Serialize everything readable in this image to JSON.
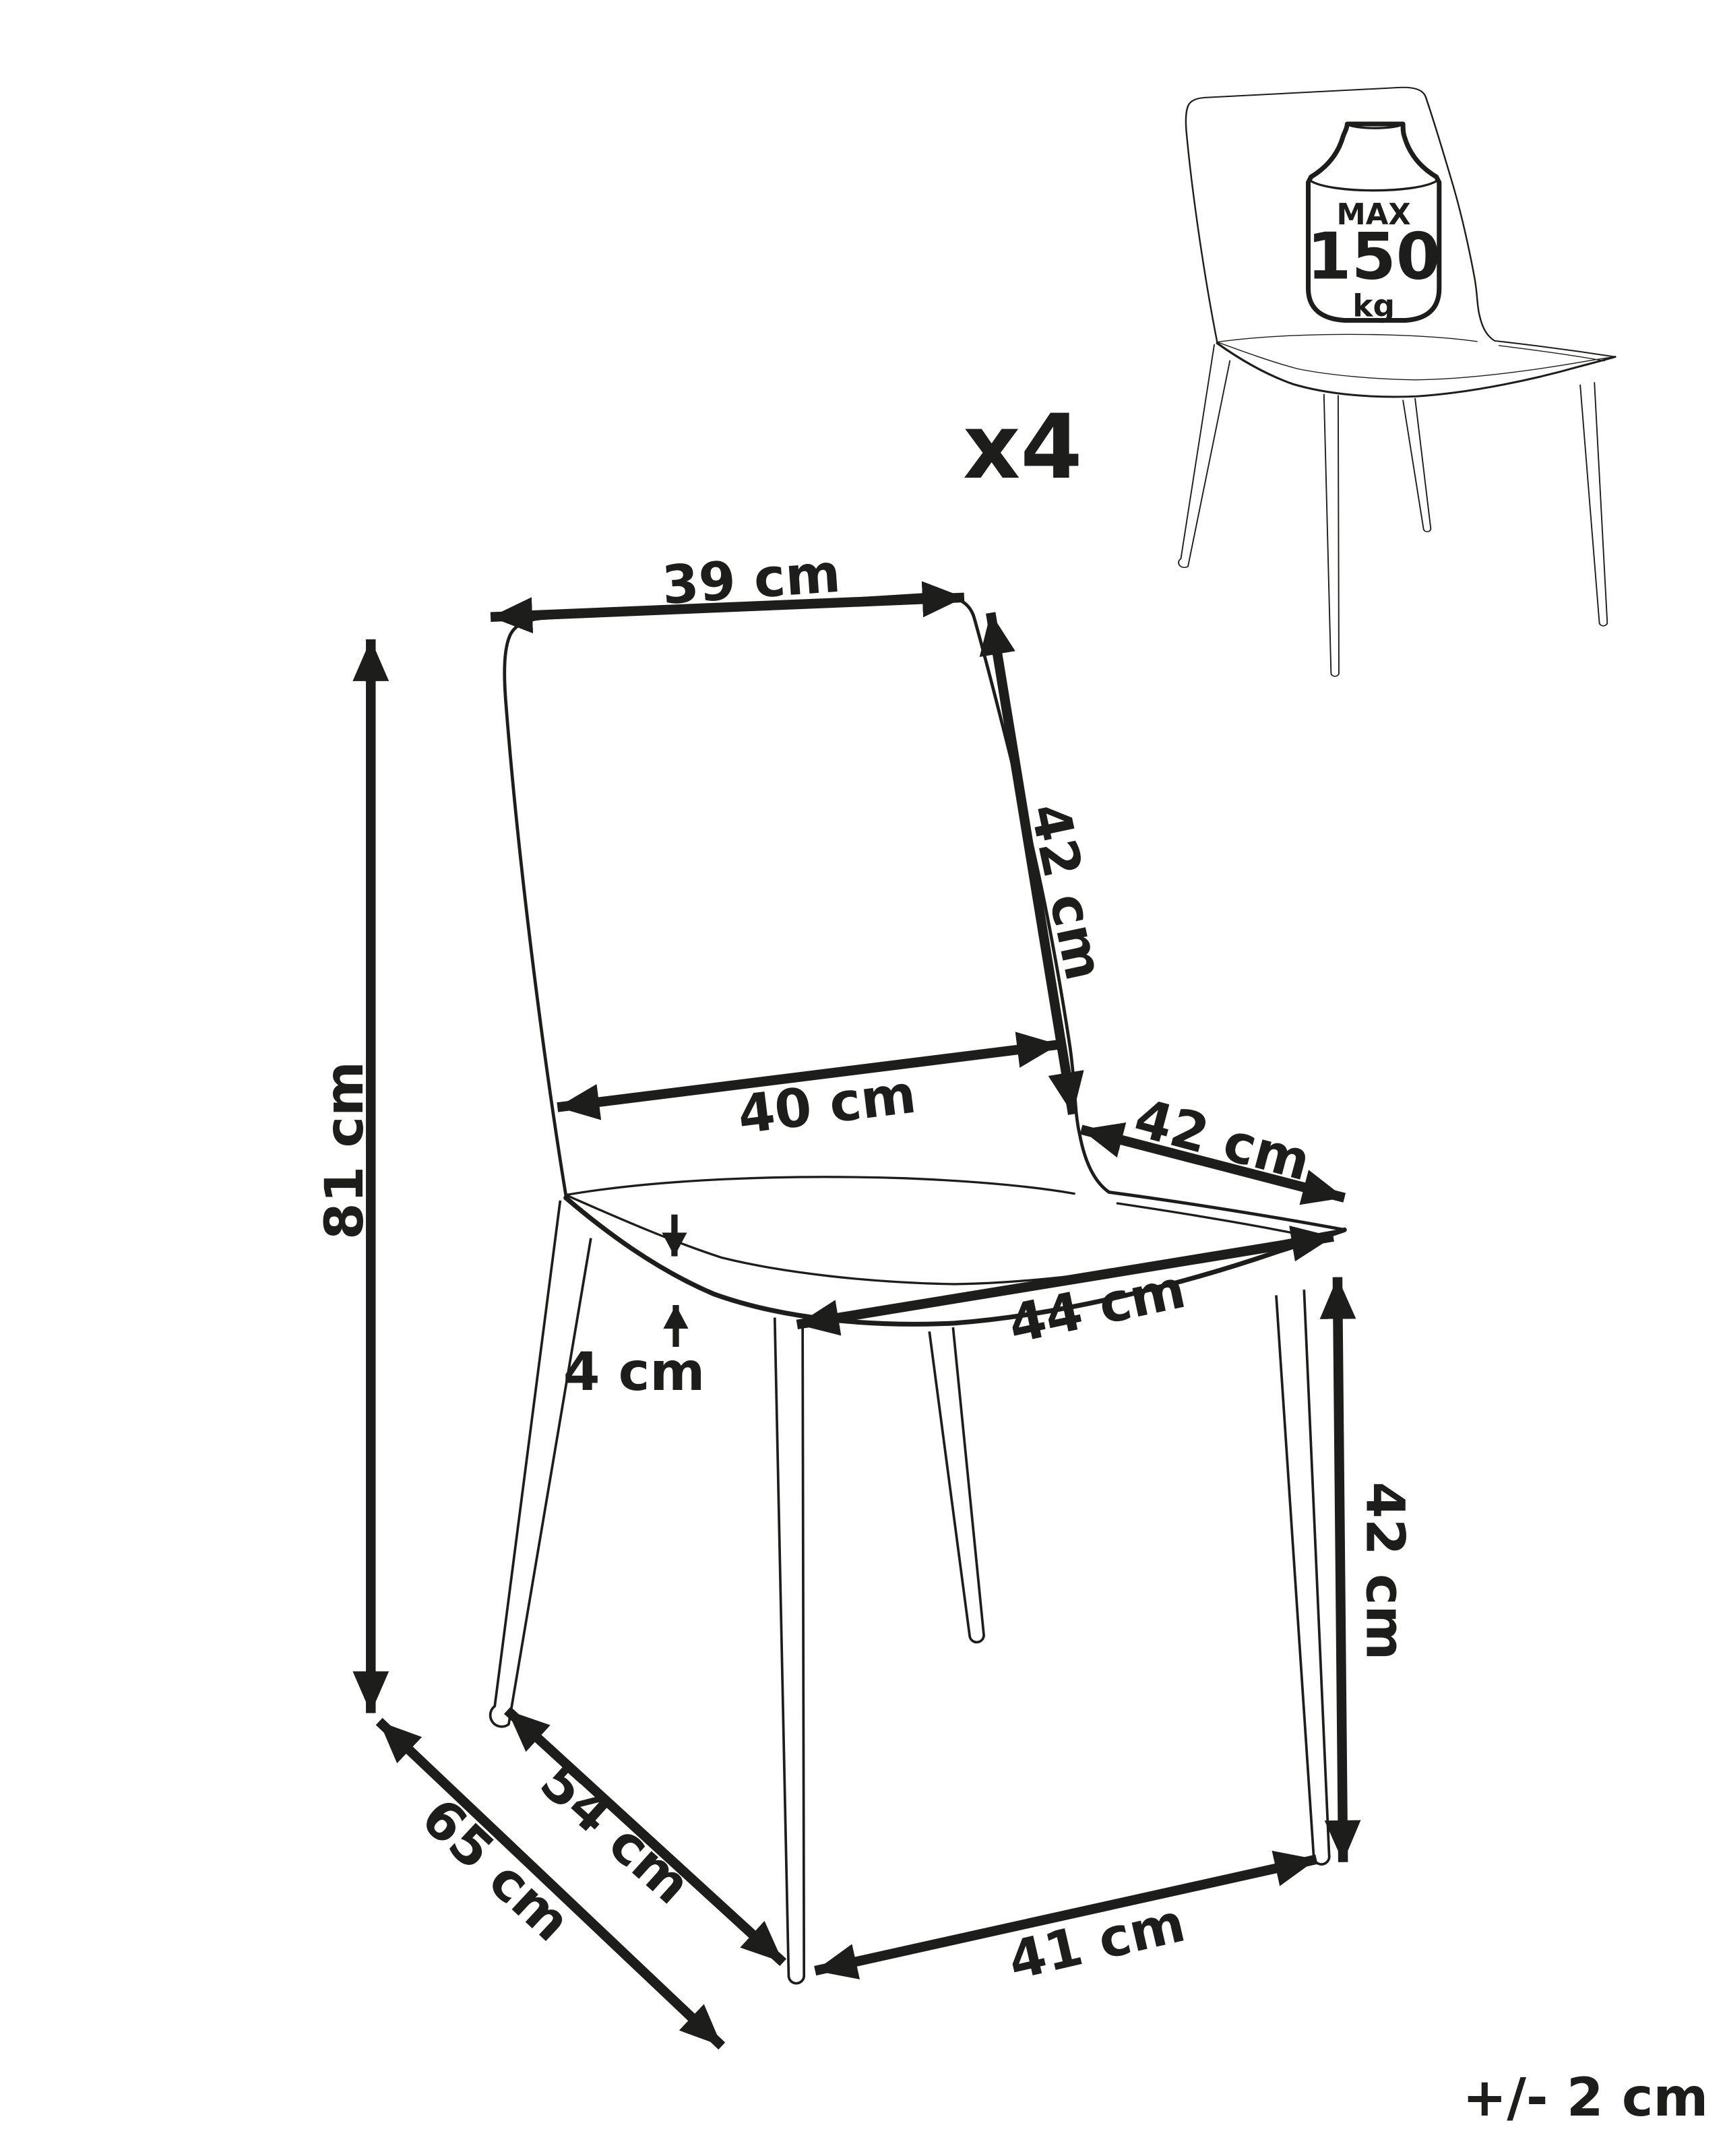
{
  "figure": {
    "quantity": "x4",
    "tolerance": "+/- 2 cm"
  },
  "weight_limit": {
    "label": "MAX",
    "value": "150",
    "unit": "kg"
  },
  "dimensions": {
    "backrest_width": "39 cm",
    "backrest_height": "42 cm",
    "backrest_bottom_width": "40 cm",
    "seat_side_depth": "42 cm",
    "seat_front_width": "44 cm",
    "cushion_thickness": "4 cm",
    "total_height": "81 cm",
    "seat_height": "42 cm",
    "leg_span_side": "54 cm",
    "total_depth": "65 cm",
    "leg_span_front": "41 cm"
  },
  "colors": {
    "line": "#1d1d1b",
    "background": "#ffffff"
  }
}
